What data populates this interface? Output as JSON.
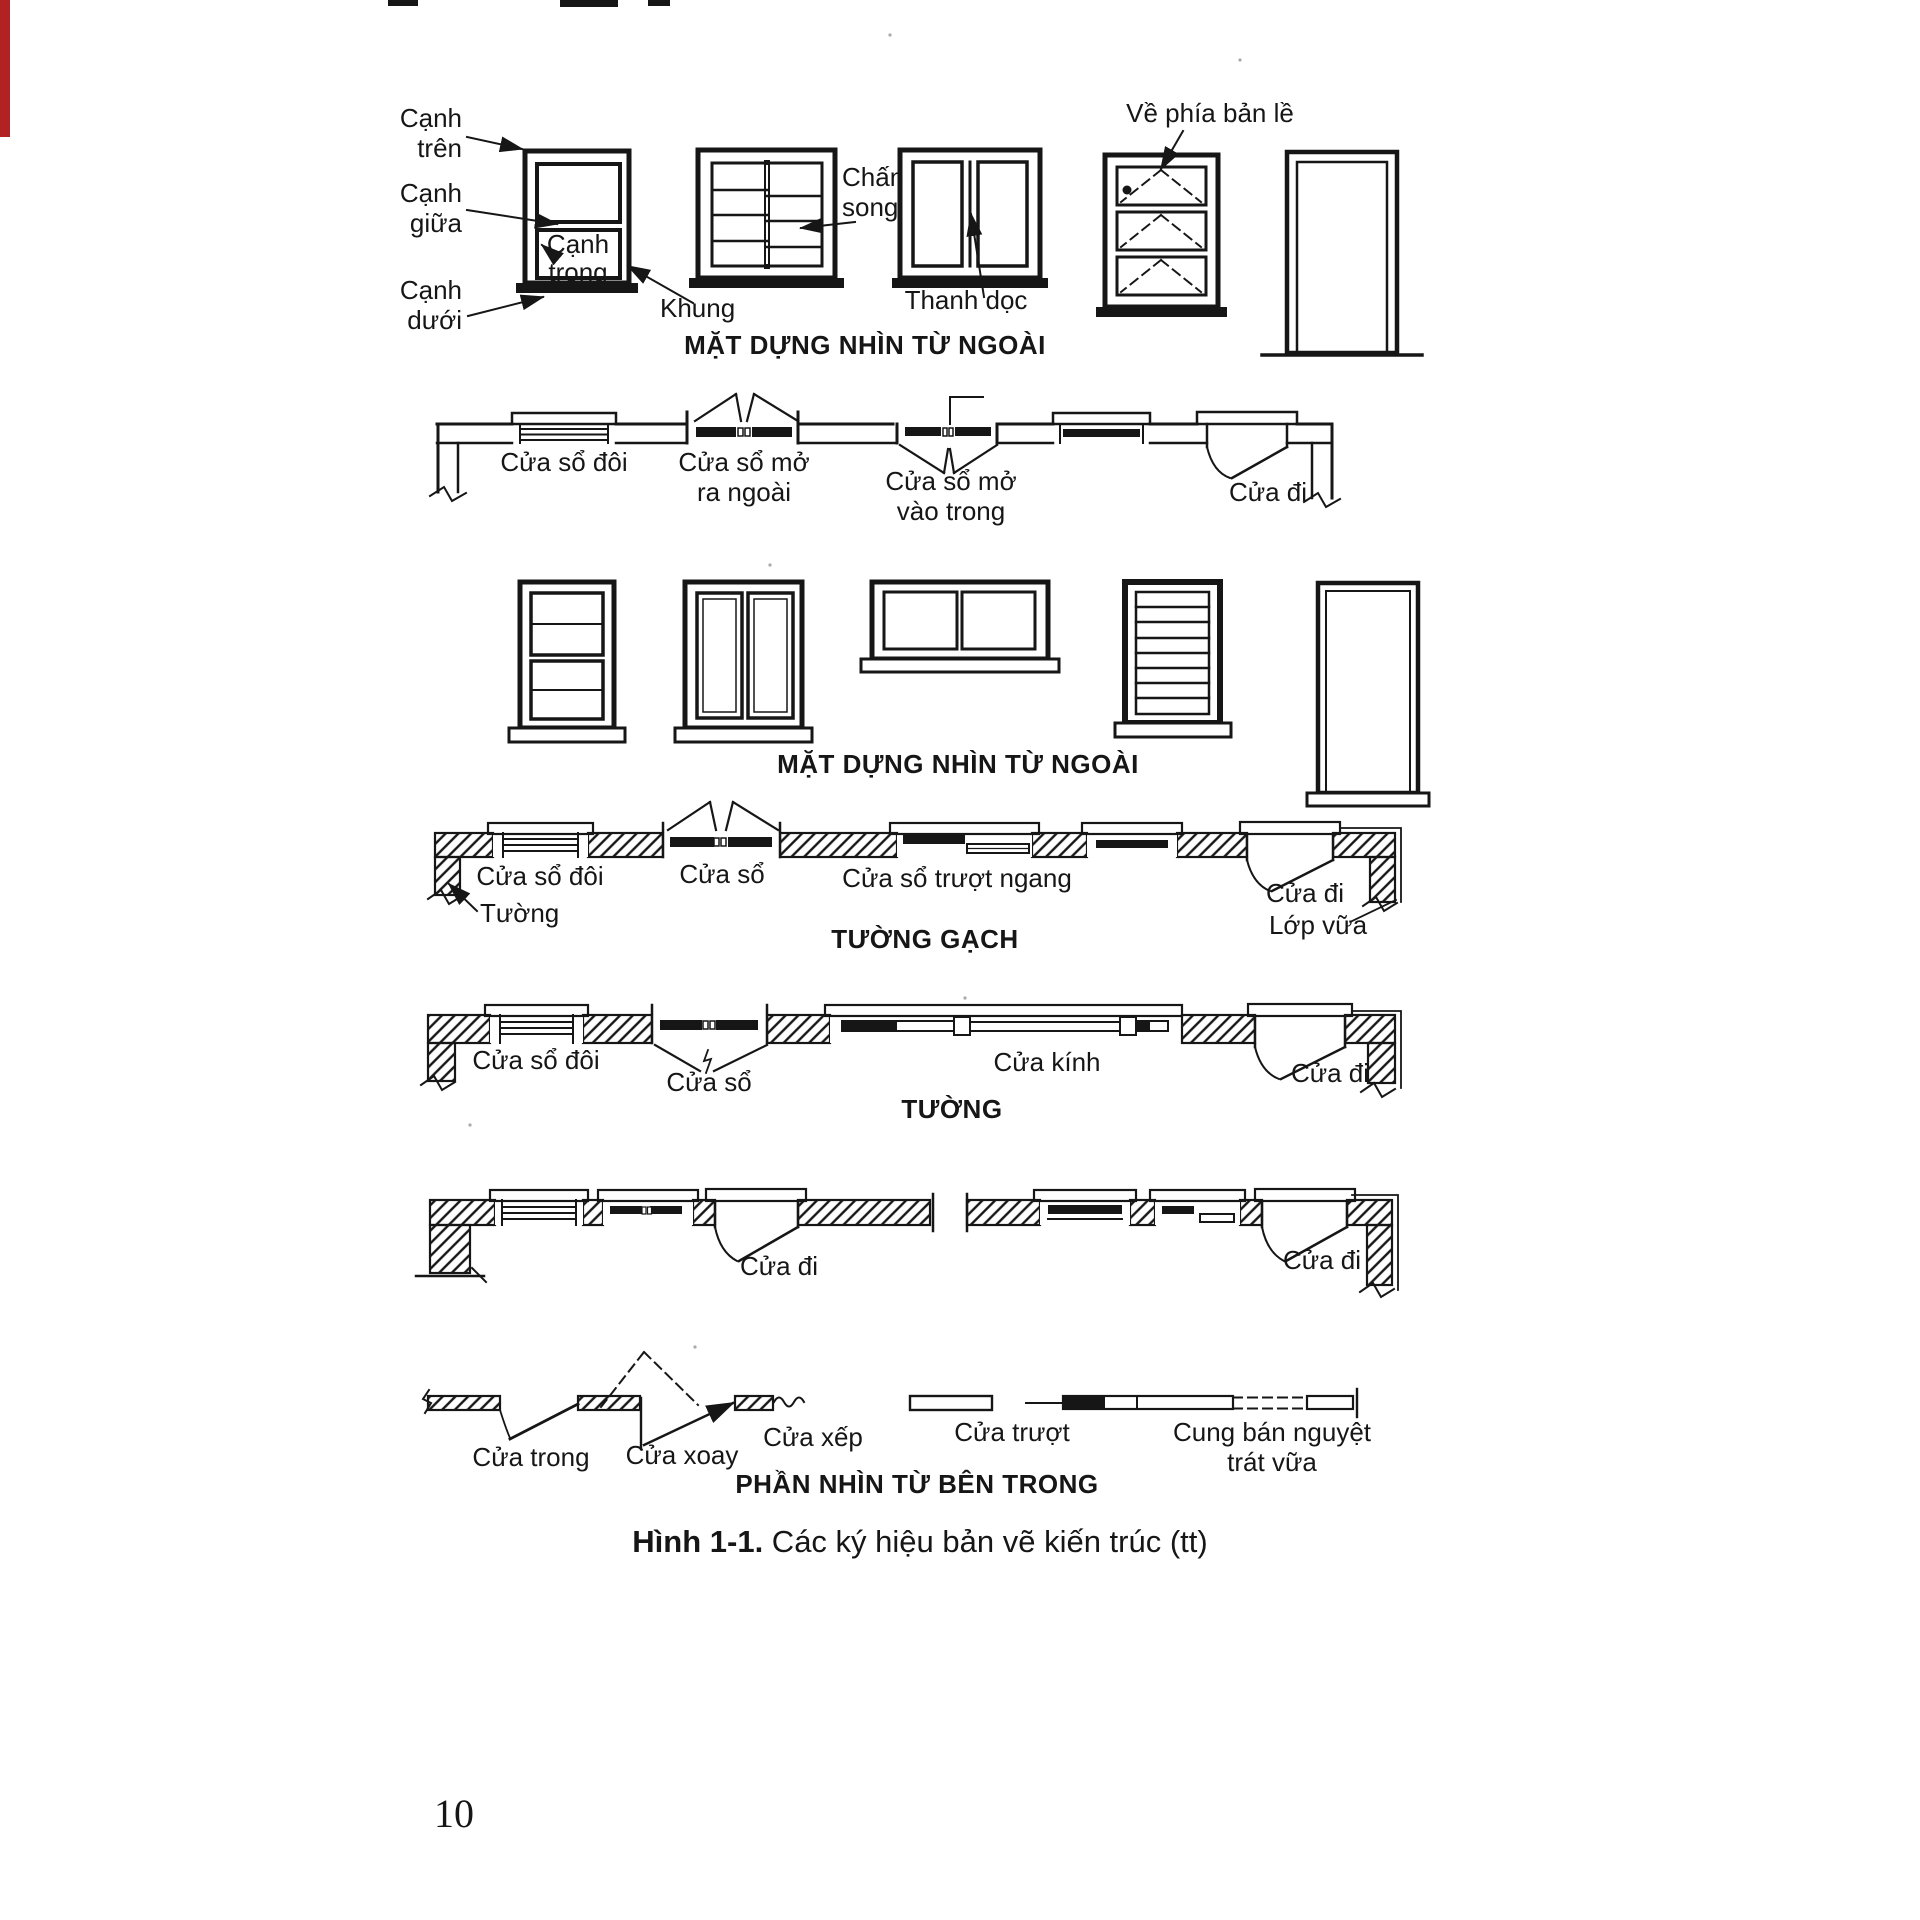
{
  "page": {
    "number": "10"
  },
  "caption": {
    "bold": "Hình 1-1.",
    "rest": " Các ký hiệu bản vẽ kiến trúc (tt)"
  },
  "artifacts": {
    "red_edge_color": "#b22222"
  },
  "elev1": {
    "title": "MẶT DỰNG NHÌN TỪ NGOÀI",
    "canh_tren": [
      "Cạnh",
      "trên"
    ],
    "canh_giua": [
      "Cạnh",
      "giữa"
    ],
    "canh_trong": [
      "Cạnh",
      "trong"
    ],
    "canh_duoi": [
      "Cạnh",
      "dưới"
    ],
    "khung": "Khung",
    "chan_song": [
      "Chấn",
      "song"
    ],
    "thanh_doc": "Thanh dọc",
    "ve_phia_ban_le": "Về phía bản lề"
  },
  "plan1": {
    "cua_so_doi": "Cửa sổ đôi",
    "cua_so_mo_ra_ngoai": [
      "Cửa sổ mở",
      "ra ngoài"
    ],
    "cua_so_mo_vao_trong": [
      "Cửa sổ mở",
      "vào trong"
    ],
    "cua_di": "Cửa đi"
  },
  "elev2": {
    "title": "MẶT DỰNG NHÌN TỪ NGOÀI"
  },
  "plan2": {
    "cua_so_doi": "Cửa sổ đôi",
    "cua_so": "Cửa sổ",
    "cua_so_truot_ngang": "Cửa sổ trượt ngang",
    "cua_di": "Cửa đi",
    "tuong": "Tường",
    "lop_vua": "Lớp vữa",
    "heading": "TƯỜNG GẠCH"
  },
  "plan3": {
    "cua_so_doi": "Cửa sổ đôi",
    "cua_so": "Cửa sổ",
    "cua_kinh": "Cửa kính",
    "cua_di": "Cửa đi",
    "heading": "TƯỜNG"
  },
  "plan4": {
    "cua_di_left": "Cửa đi",
    "cua_di_right": "Cửa đi"
  },
  "interior": {
    "cua_trong": "Cửa trong",
    "cua_xoay": "Cửa xoay",
    "cua_xep": "Cửa xếp",
    "cua_truot": "Cửa trượt",
    "cung_ban_nguyet": [
      "Cung bán nguyệt",
      "trát vữa"
    ],
    "heading": "PHẦN NHÌN TỪ BÊN TRONG"
  }
}
